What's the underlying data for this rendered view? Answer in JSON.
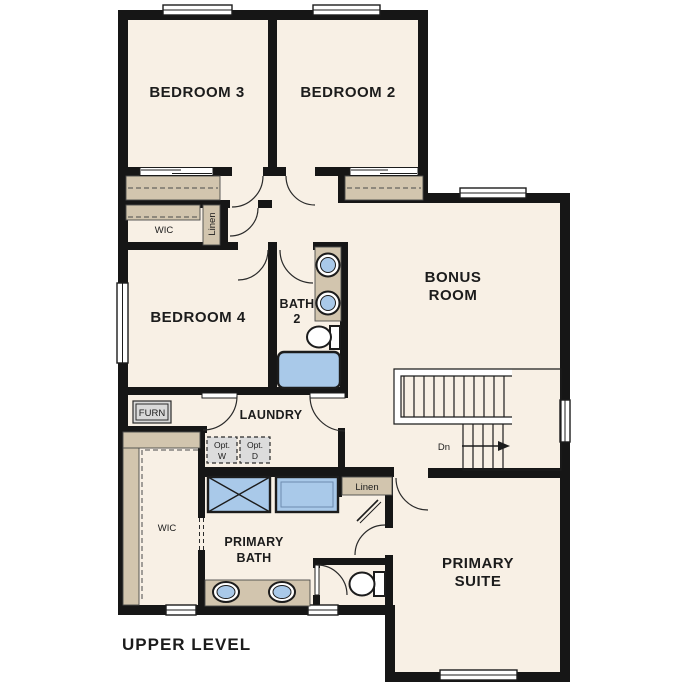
{
  "title": "UPPER LEVEL",
  "colors": {
    "floor": "#f8f0e5",
    "wall": "#161616",
    "closet_shelf": "#d2c5ae",
    "fixture_blue": "#a9c9e9",
    "option_box_gray": "#dcdcdc",
    "background": "#ffffff"
  },
  "rooms": {
    "bedroom3": {
      "label": "BEDROOM 3"
    },
    "bedroom2": {
      "label": "BEDROOM 2"
    },
    "bedroom4": {
      "label": "BEDROOM 4"
    },
    "bonus": {
      "line1": "BONUS",
      "line2": "ROOM"
    },
    "bath2": {
      "line1": "BATH",
      "line2": "2"
    },
    "laundry": {
      "label": "LAUNDRY"
    },
    "primary_bath": {
      "line1": "PRIMARY",
      "line2": "BATH"
    },
    "primary_suite": {
      "line1": "PRIMARY",
      "line2": "SUITE"
    }
  },
  "closets": {
    "wic_upper": {
      "label": "WIC"
    },
    "linen_upper": {
      "label": "Linen"
    },
    "wic_primary": {
      "label": "WIC"
    },
    "linen_primary": {
      "label": "Linen"
    }
  },
  "equipment": {
    "furnace": {
      "label": "FURN"
    },
    "opt_washer": {
      "line1": "Opt.",
      "line2": "W"
    },
    "opt_dryer": {
      "line1": "Opt.",
      "line2": "D"
    }
  },
  "stairs": {
    "down_label": "Dn"
  }
}
